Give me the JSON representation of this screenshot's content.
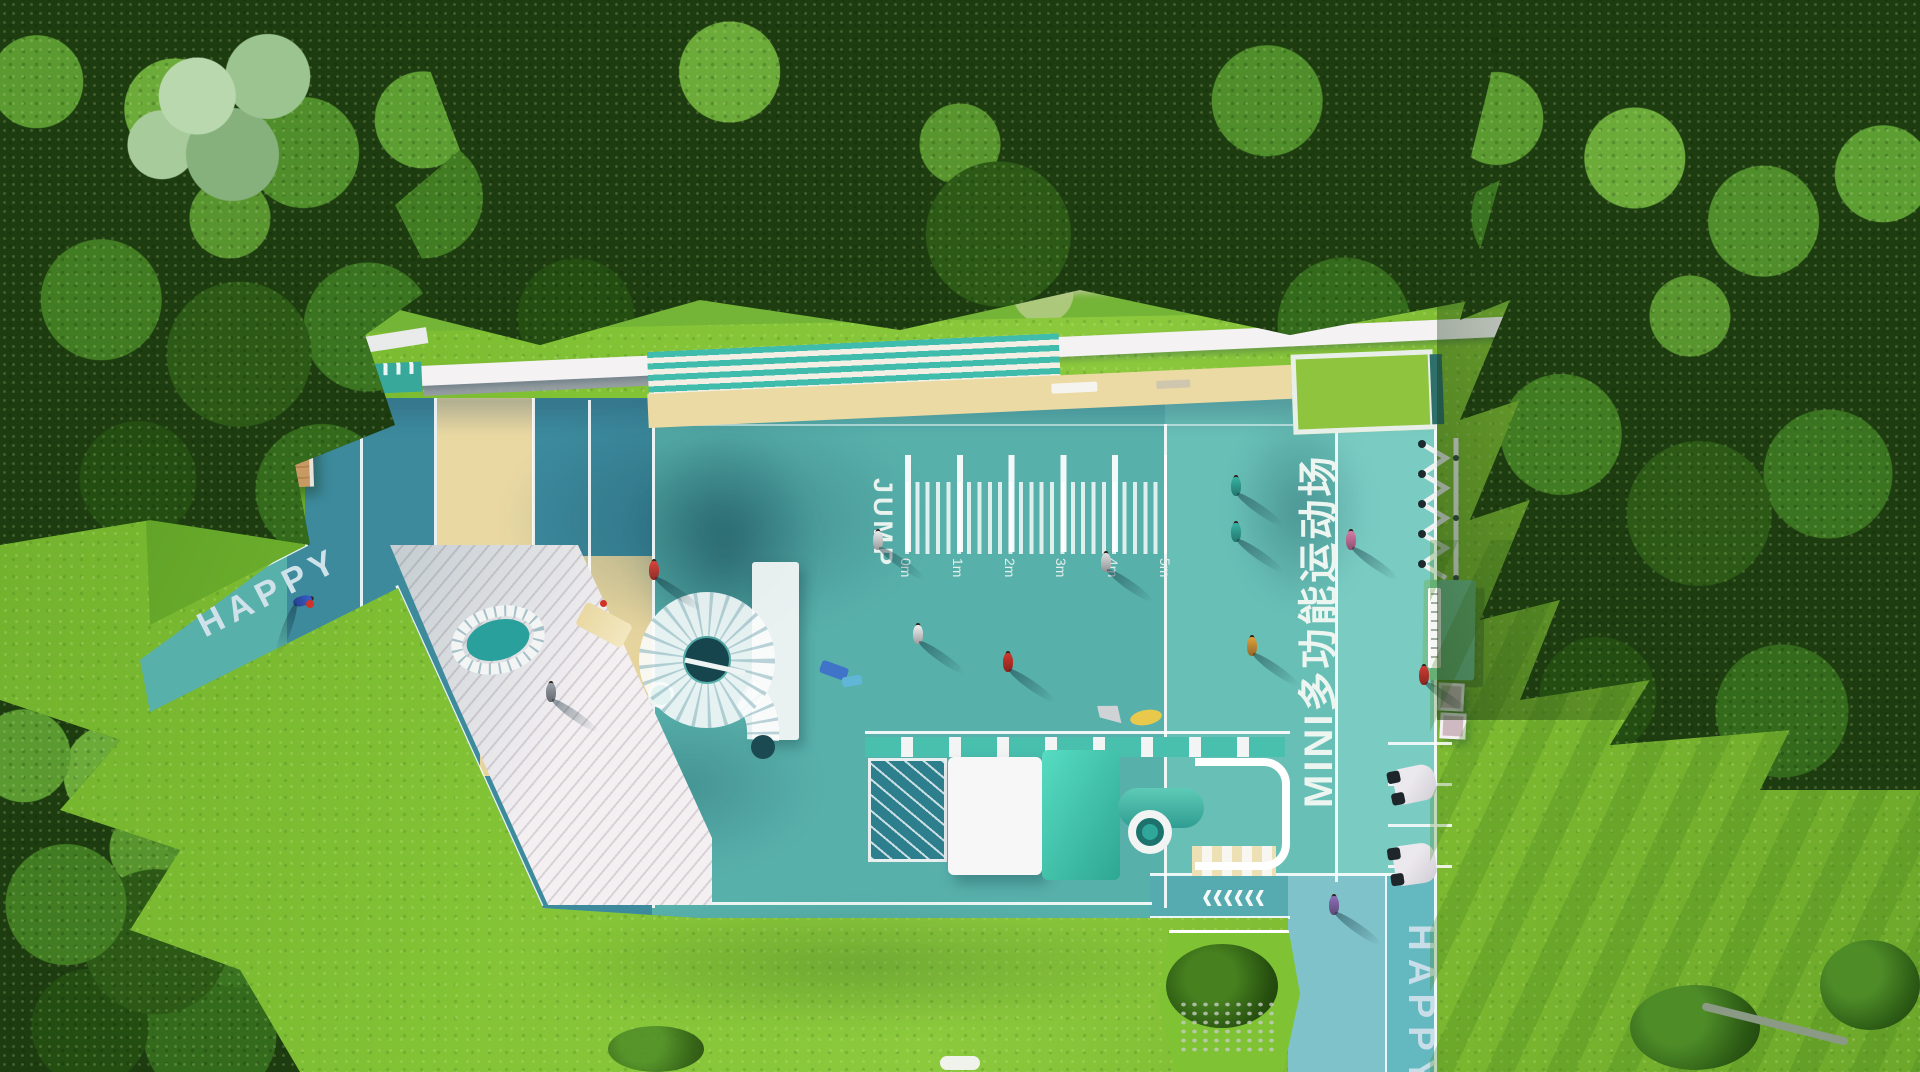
{
  "scene": {
    "labels": {
      "happy_left": "HAPPY",
      "jump": "JUMP",
      "court_title": "MINI多功能运动场",
      "happy_bottom": "HAPPY"
    },
    "ruler_marks": [
      "0m",
      "1m",
      "2m",
      "3m",
      "4m",
      "5m"
    ],
    "icons": {
      "chevrons_left": "‹‹‹‹‹‹"
    },
    "colors": {
      "court_teal_dark": "#3d8a9d",
      "court_teal_mid": "#58b0ab",
      "court_teal_light": "#68bfb6",
      "path_teal": "#7accc3",
      "sand": "#e9d8a2",
      "deck_white": "#f2eef0",
      "roof_white": "#f4f2f3",
      "grass_bright": "#84c436",
      "forest_dark": "#1d3c10",
      "accent_teal": "#3fbcab",
      "kiosk_green": "#74c294"
    }
  }
}
